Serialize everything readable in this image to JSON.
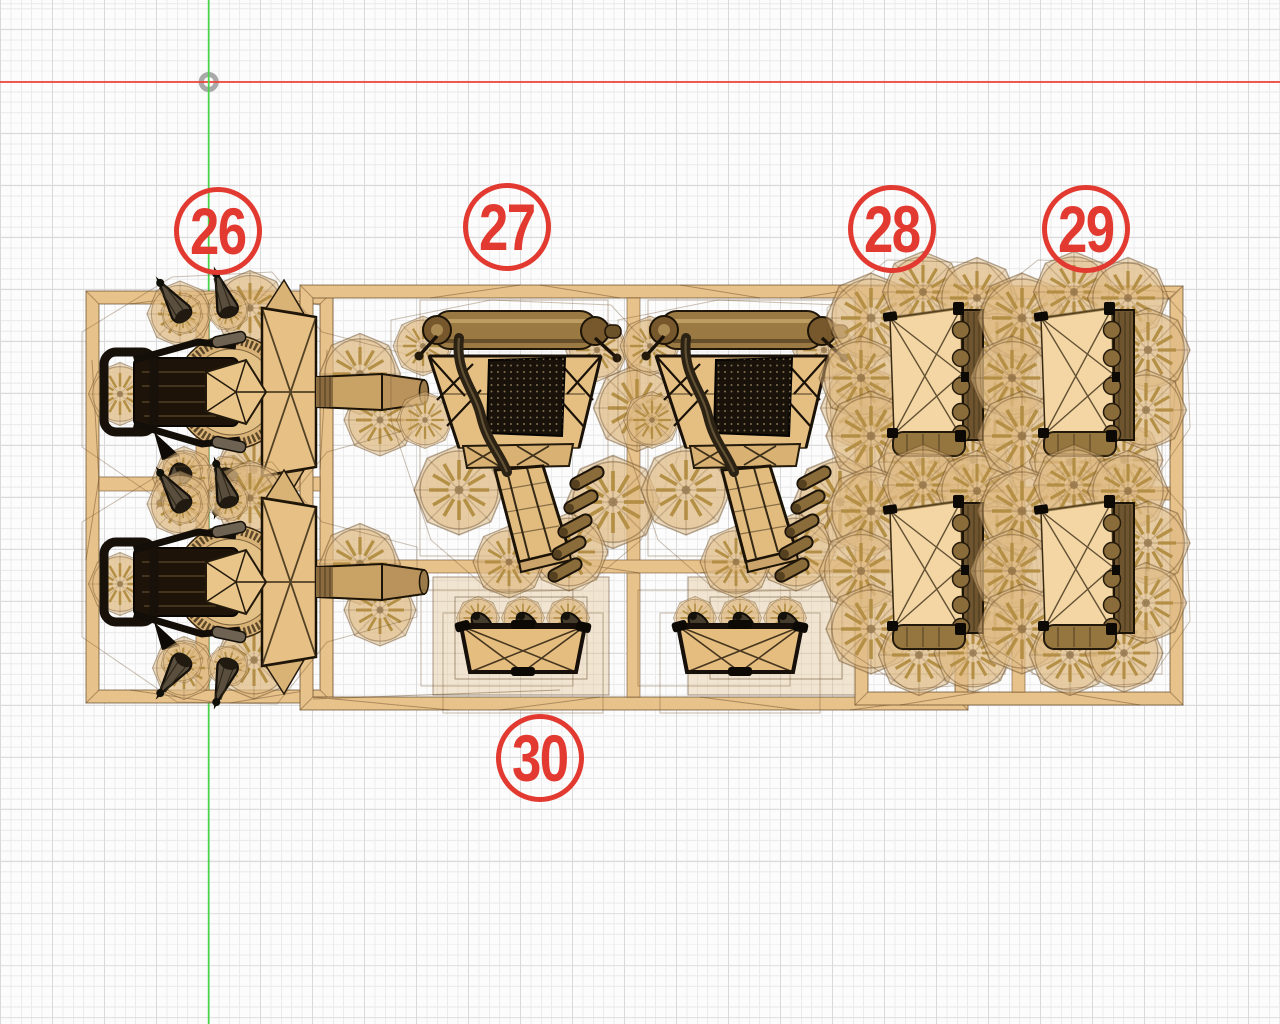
{
  "viewport": {
    "type": "3d-cad-top-view",
    "background_color": "#fcfcfc",
    "grid": {
      "minor_color": "#ebebeb",
      "major_color": "#d9d9d9",
      "minor_step_px": 10.4,
      "major_step_px": 52
    },
    "axes": {
      "x_axis_color": "#ee4338",
      "y_axis_color": "#4bd44b"
    },
    "origin_marker_color": "#a2a2a2",
    "model": {
      "material_color": "#e8c28b",
      "panel_color": "#f3d6a3",
      "log_color": "#96763f",
      "outline_color": "#1c1307"
    }
  },
  "annotations": {
    "badge_color": "#e23a30",
    "badges": [
      {
        "label": "26"
      },
      {
        "label": "27"
      },
      {
        "label": "28"
      },
      {
        "label": "29"
      },
      {
        "label": "30"
      }
    ]
  }
}
